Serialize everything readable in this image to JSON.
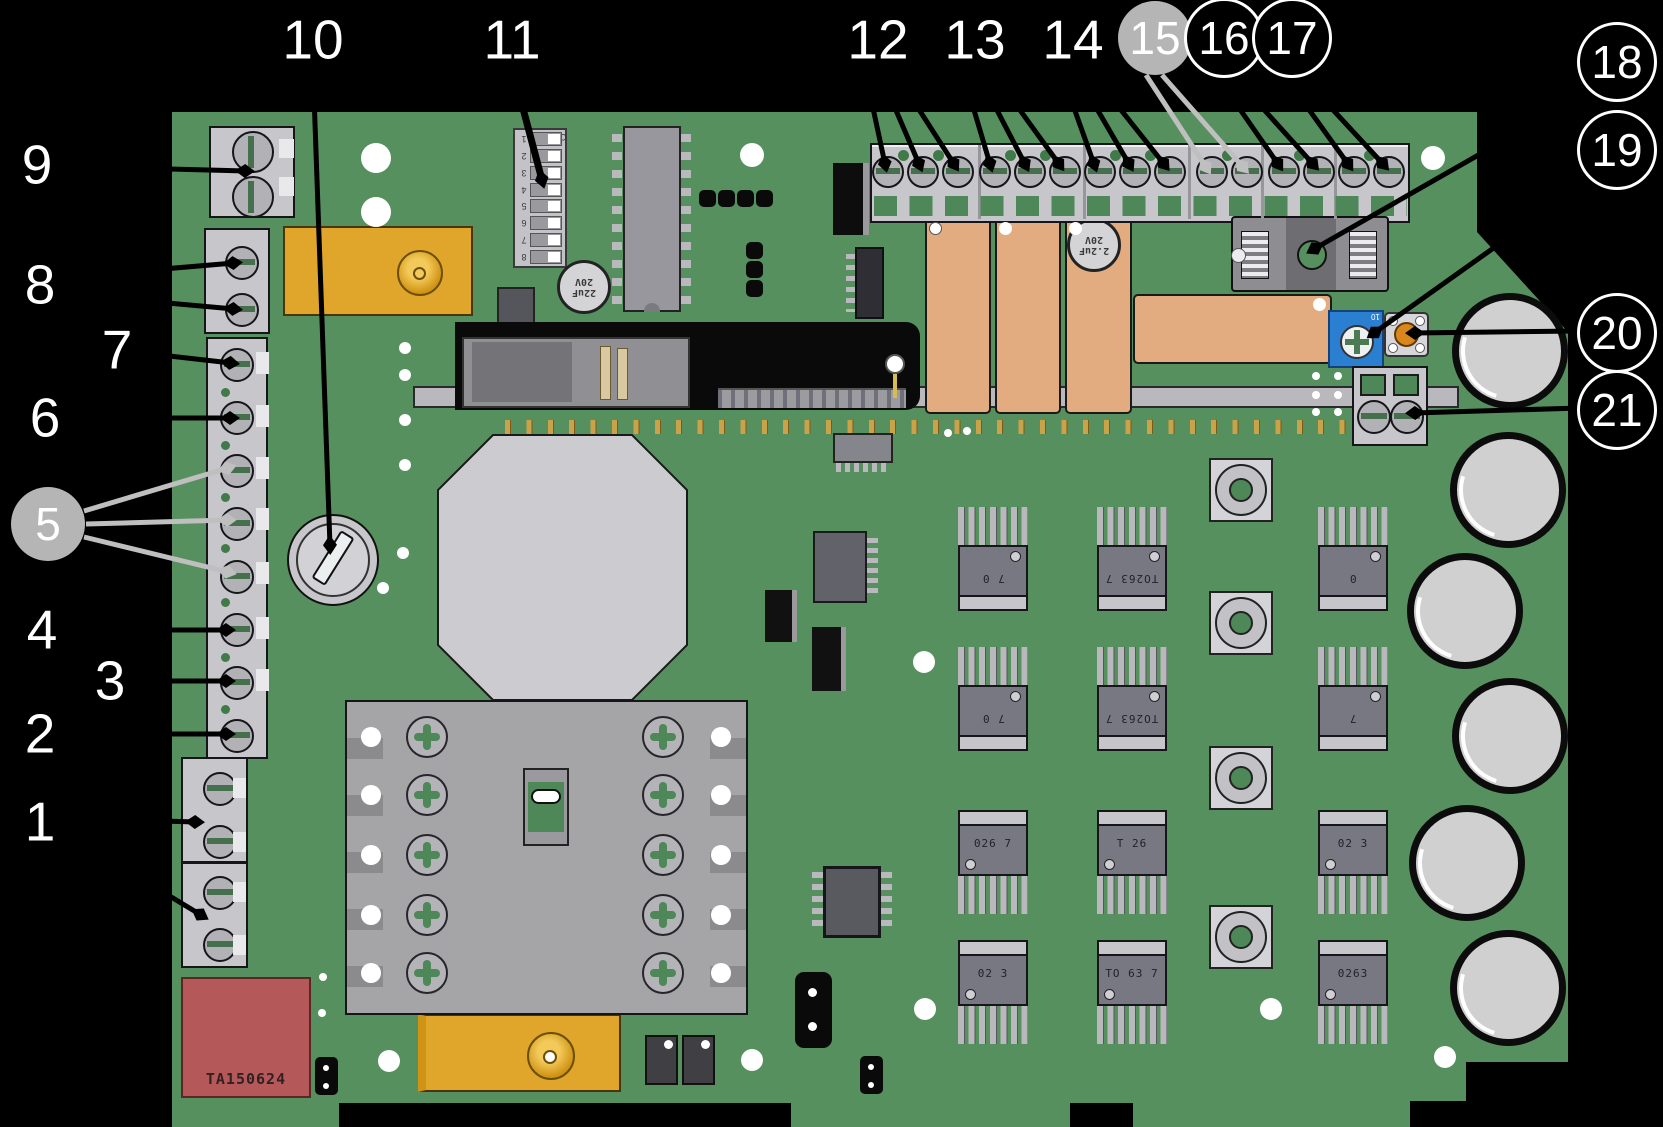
{
  "diagram": {
    "description": "Printed circuit board callout diagram with numbered component pointers",
    "board_id_text": "TA150624"
  },
  "callouts": [
    {
      "id": 1,
      "label": "1",
      "style": "plain"
    },
    {
      "id": 2,
      "label": "2",
      "style": "plain"
    },
    {
      "id": 3,
      "label": "3",
      "style": "plain"
    },
    {
      "id": 4,
      "label": "4",
      "style": "plain"
    },
    {
      "id": 5,
      "label": "5",
      "style": "gray-circle"
    },
    {
      "id": 6,
      "label": "6",
      "style": "plain"
    },
    {
      "id": 7,
      "label": "7",
      "style": "plain"
    },
    {
      "id": 8,
      "label": "8",
      "style": "plain"
    },
    {
      "id": 9,
      "label": "9",
      "style": "plain"
    },
    {
      "id": 10,
      "label": "10",
      "style": "plain"
    },
    {
      "id": 11,
      "label": "11",
      "style": "plain"
    },
    {
      "id": 12,
      "label": "12",
      "style": "plain"
    },
    {
      "id": 13,
      "label": "13",
      "style": "plain"
    },
    {
      "id": 14,
      "label": "14",
      "style": "plain"
    },
    {
      "id": 15,
      "label": "15",
      "style": "gray-circle"
    },
    {
      "id": 16,
      "label": "16",
      "style": "black-circle"
    },
    {
      "id": 17,
      "label": "17",
      "style": "black-circle"
    },
    {
      "id": 18,
      "label": "18",
      "style": "black-circle"
    },
    {
      "id": 19,
      "label": "19",
      "style": "black-circle"
    },
    {
      "id": 20,
      "label": "20",
      "style": "black-circle"
    },
    {
      "id": 21,
      "label": "21",
      "style": "black-circle"
    }
  ],
  "board": {
    "transformer_label": "TA150624",
    "capacitor_label_1": "22uF 20V",
    "capacitor_label_2": "2.2uF 20V",
    "trimmer_mark": "10",
    "dip_switch": {
      "on_label": "ON",
      "positions": [
        "1",
        "2",
        "3",
        "4",
        "5",
        "6",
        "7",
        "8"
      ]
    },
    "mosfet_rows": [
      {
        "orientation": "pins-up",
        "labels": [
          "7 0",
          "TO263 7",
          "0"
        ]
      },
      {
        "orientation": "pins-up",
        "labels": [
          "7 0",
          "TO263 7",
          "7"
        ]
      },
      {
        "orientation": "pins-down",
        "labels": [
          "026 7",
          "T 26",
          "02 3"
        ]
      },
      {
        "orientation": "pins-down",
        "labels": [
          "02 3",
          "TO 63 7",
          "0263"
        ]
      }
    ],
    "colors": {
      "pcb_green": "#57905f",
      "pad_green": "#4e8758",
      "relay_tan": "#e2ab80",
      "component_yellow": "#dfa62b",
      "transformer_red": "#b4585a",
      "trimmer_blue": "#2b7fd0",
      "button_orange": "#d9871c",
      "heatsink_gray": "#a5a5a8",
      "callout_gray_line": "#bfbfbf"
    }
  }
}
